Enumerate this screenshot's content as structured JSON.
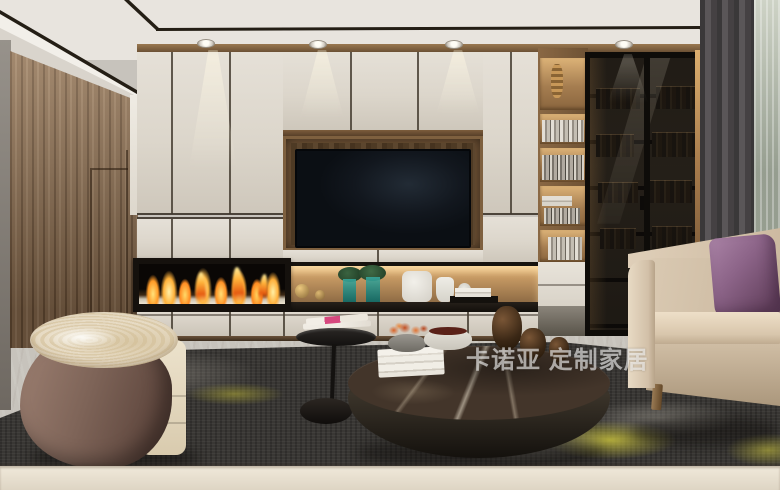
{
  "watermark": {
    "text": "卡诺亚 定制家居"
  },
  "palette": {
    "ceiling": "#e8e4de",
    "ceilingTray": "#f3f0ea",
    "trimDark": "#241e15",
    "cream": "#ded8ce",
    "woodWall": "#8a6c4f",
    "woodHeader": "#7c5f41",
    "tvBlack": "#10151b",
    "counterBlack": "#17130e",
    "flameOrange": "#ff9526",
    "flameYellow": "#ffd95e",
    "shelfWood": "#a07a50",
    "glassDark": "#2a241c",
    "curtain": "#4a4748",
    "sheer": "#a3aa9c",
    "floor": "#c7c3bc",
    "rug": "#393734",
    "rugYellow": "#c4bd3a",
    "sofa": "#dcccb5",
    "pillowPurple": "#8c6488",
    "pillowBrown": "#44301f",
    "chairShell": "#7e6458",
    "chairCream": "#e7dbc4",
    "marbleTable": "#43352a",
    "bronze": "#8d6f47",
    "foreground": "#e7e0d2",
    "watermark": "rgba(255,255,255,0.6)"
  }
}
